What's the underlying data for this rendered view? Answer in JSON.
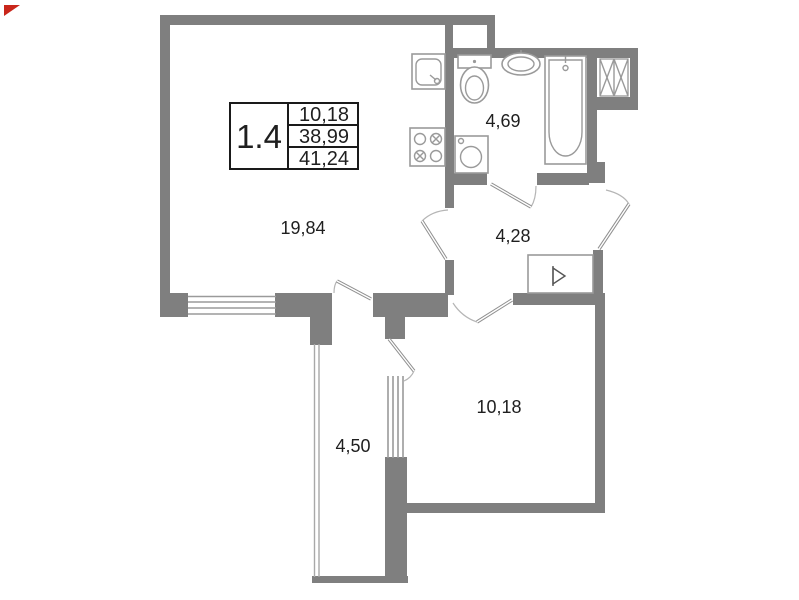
{
  "legend": {
    "unit": "1.4",
    "values": [
      "10,18",
      "38,99",
      "41,24"
    ]
  },
  "rooms": {
    "living_kitchen": {
      "label": "19,84"
    },
    "bathroom": {
      "label": "4,69"
    },
    "hallway": {
      "label": "4,28"
    },
    "bedroom": {
      "label": "10,18"
    },
    "loggia": {
      "label": "4,50"
    }
  },
  "colors": {
    "wall": "#7f7f7f",
    "thin_line": "#9a9a9a",
    "text": "#1f1f1f",
    "legend_border": "#1a1a1a",
    "background": "#ffffff",
    "red_marker": "#c9261b"
  },
  "icons": {
    "kitchen_sink": "kitchen-sink-icon",
    "stove": "stove-icon",
    "toilet": "toilet-icon",
    "washbasin": "washbasin-icon",
    "bathtub": "bathtub-icon",
    "washing_machine": "washing-machine-icon",
    "vent_shaft": "vent-shaft-icon",
    "closet": "closet-icon",
    "red_marker": "red-marker-icon"
  }
}
